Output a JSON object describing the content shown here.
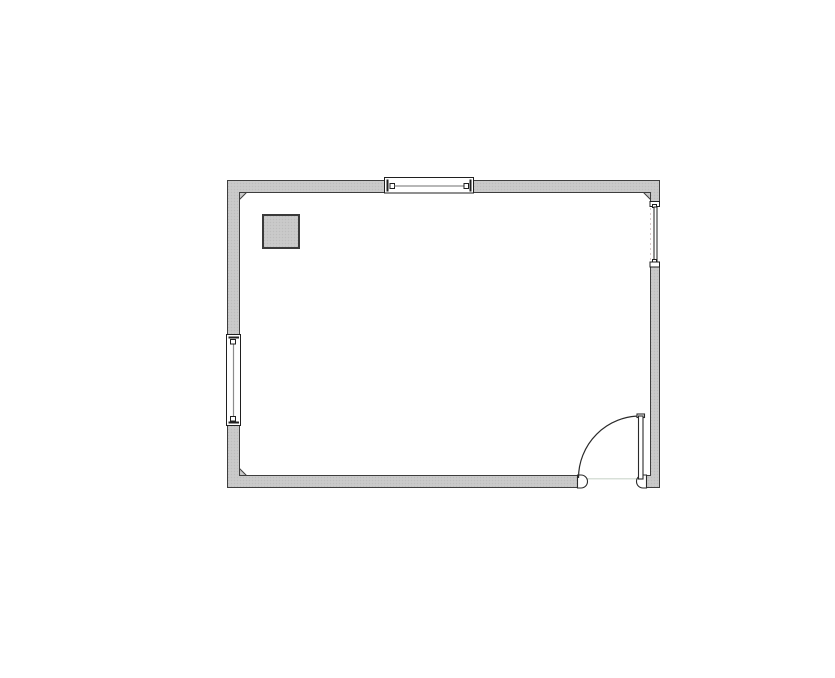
{
  "page": {
    "kind": "architectural-floor-plan",
    "background_color": "#ffffff",
    "visible_text": "none"
  },
  "colors": {
    "wall_fill": "#c8c8c8",
    "wall_fill_dither_dark": "#bdbdbd",
    "wall_fill_dither_light": "#d2d0d2",
    "wall_outline": "#3e3e3e",
    "symbol_outline": "#1f1f1f",
    "window_glass_line": "#8c8c8c",
    "door_outline": "#2a2a2a",
    "threshold_line": "#ccd6cb",
    "opening_dashed_line": "#d8c7c7",
    "interior_fill": "#ffffff"
  },
  "floor_plan": {
    "room": {
      "outer_left_px": 227,
      "outer_top_px": 180,
      "outer_right_px": 660,
      "outer_bottom_px": 488,
      "wall_thickness_px": 12
    },
    "features": [
      {
        "id": "column-top-left",
        "type": "column",
        "shape": "square",
        "x_px": 262,
        "y_px": 214,
        "width_px": 37,
        "height_px": 34
      },
      {
        "id": "window-top",
        "type": "window",
        "wall": "top",
        "from_x_px": 385,
        "to_x_px": 473,
        "symbol": "frame box with end stops and center glass line"
      },
      {
        "id": "window-left",
        "type": "window",
        "wall": "left",
        "from_y_px": 335,
        "to_y_px": 425,
        "symbol": "frame box with end stops and center glass line"
      },
      {
        "id": "opening-right",
        "type": "window-opening",
        "wall": "right",
        "from_y_px": 201,
        "to_y_px": 267,
        "symbol": "jamb caps, thin outer frame, faint dashed centerline"
      },
      {
        "id": "door-bottom-right",
        "type": "door",
        "wall": "bottom",
        "opening_from_x_px": 578,
        "opening_to_x_px": 644,
        "hinge_side": "right",
        "swing": "quarter-circle inward",
        "leaf": "vertical, open 90 degrees",
        "arc_radius_px": 62,
        "jambs": "rounded end caps",
        "threshold": "faint light line"
      }
    ]
  }
}
